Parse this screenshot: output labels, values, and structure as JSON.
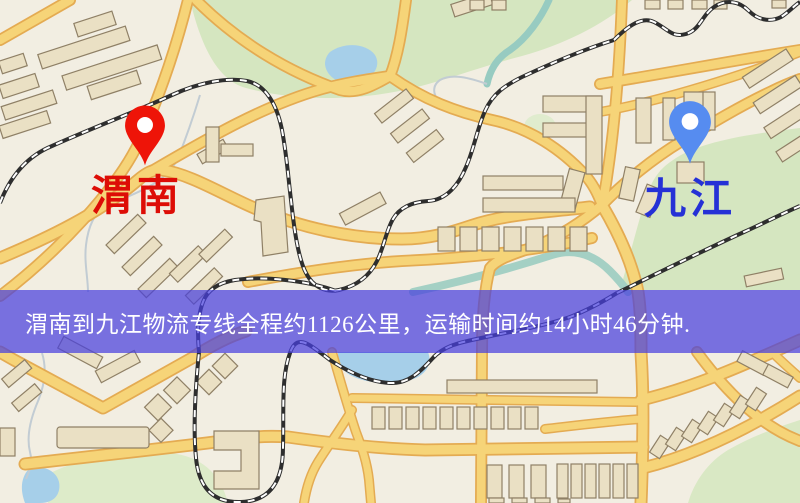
{
  "banner": {
    "text": "渭南到九江物流专线全程约1126公里，运输时间约14小时46分钟.",
    "origin": "渭南",
    "destination": "九江",
    "distance": "1126公里",
    "duration": "14小时46分钟",
    "overlay_color": "#4840de",
    "text_color": "#ffffff"
  },
  "markers": {
    "origin": {
      "label": "渭南",
      "pin_color": "#ee1408",
      "label_color": "#dd0d06"
    },
    "destination": {
      "label": "九江",
      "pin_color": "#568cf0",
      "label_color": "#2531d6"
    }
  },
  "map": {
    "background": "#f2eee2",
    "road_fill": "#f6d478",
    "road_casing": "#e4ab52",
    "building_fill": "#eae0c4",
    "building_stroke": "#8f8066",
    "green_area": "#d5e6c0",
    "water": "#a6cfe9",
    "railway": "#2e2e2e"
  }
}
